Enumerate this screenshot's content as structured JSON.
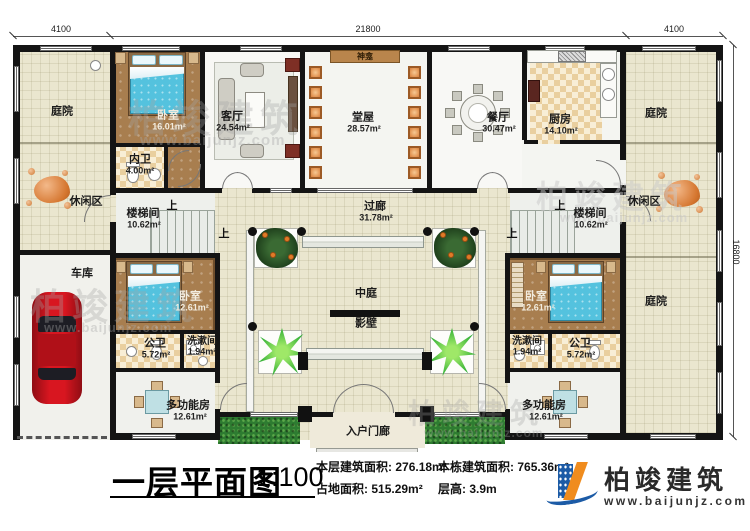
{
  "watermark": {
    "text": "柏竣建筑",
    "url": "www.baijunjz.com"
  },
  "dimensions": {
    "top_left": "4100",
    "top_center": "21800",
    "top_right": "4100",
    "right": "16800"
  },
  "labels": {
    "up": "上"
  },
  "rooms": {
    "courtyard_tl": {
      "name": "庭院"
    },
    "leisure_l": {
      "name": "休闲区"
    },
    "garage": {
      "name": "车库"
    },
    "bedroom1": {
      "name": "卧室",
      "area": "16.01m²"
    },
    "inner_bath": {
      "name": "内卫",
      "area": "4.00m²"
    },
    "living": {
      "name": "客厅",
      "area": "24.54m²"
    },
    "hall": {
      "name": "堂屋",
      "area": "28.57m²"
    },
    "shrine": {
      "name": "神龛"
    },
    "dining": {
      "name": "餐厅",
      "area": "30.47m²"
    },
    "kitchen": {
      "name": "厨房",
      "area": "14.10m²"
    },
    "courtyard_tr": {
      "name": "庭院"
    },
    "leisure_r": {
      "name": "休闲区"
    },
    "stair_l": {
      "name": "楼梯间",
      "area": "10.62m²"
    },
    "stair_r": {
      "name": "楼梯间",
      "area": "10.62m²"
    },
    "corridor": {
      "name": "过廊",
      "area": "31.78m²"
    },
    "atrium": {
      "name": "中庭"
    },
    "screen_wall": {
      "name": "影壁"
    },
    "bedroom2": {
      "name": "卧室",
      "area": "12.61m²"
    },
    "pub_bath_l": {
      "name": "公卫",
      "area": "5.72m²"
    },
    "wash_l": {
      "name": "洗漱间",
      "area": "1.94m²"
    },
    "multi_l": {
      "name": "多功能房",
      "area": "12.61m²"
    },
    "bedroom3": {
      "name": "卧室",
      "area": "12.61m²"
    },
    "wash_r": {
      "name": "洗漱间",
      "area": "1.94m²"
    },
    "pub_bath_r": {
      "name": "公卫",
      "area": "5.72m²"
    },
    "multi_r": {
      "name": "多功能房",
      "area": "12.61m²"
    },
    "courtyard_br": {
      "name": "庭院"
    },
    "porch": {
      "name": "入户门廊"
    }
  },
  "titlebar": {
    "title": "一层平面图",
    "scale": "1:100",
    "stats": [
      {
        "label": "本层建筑面积:",
        "value": "276.18m²"
      },
      {
        "label": "占地面积:",
        "value": "515.29m²"
      },
      {
        "label": "本栋建筑面积:",
        "value": "765.36m²"
      },
      {
        "label": "层高:",
        "value": "3.9m"
      }
    ],
    "logo": {
      "name": "柏竣建筑",
      "url": "www.baijunjz.com"
    }
  },
  "colors": {
    "accent_blue": "#1c5ba6",
    "accent_orange": "#f08c1e",
    "wall": "#141414"
  }
}
